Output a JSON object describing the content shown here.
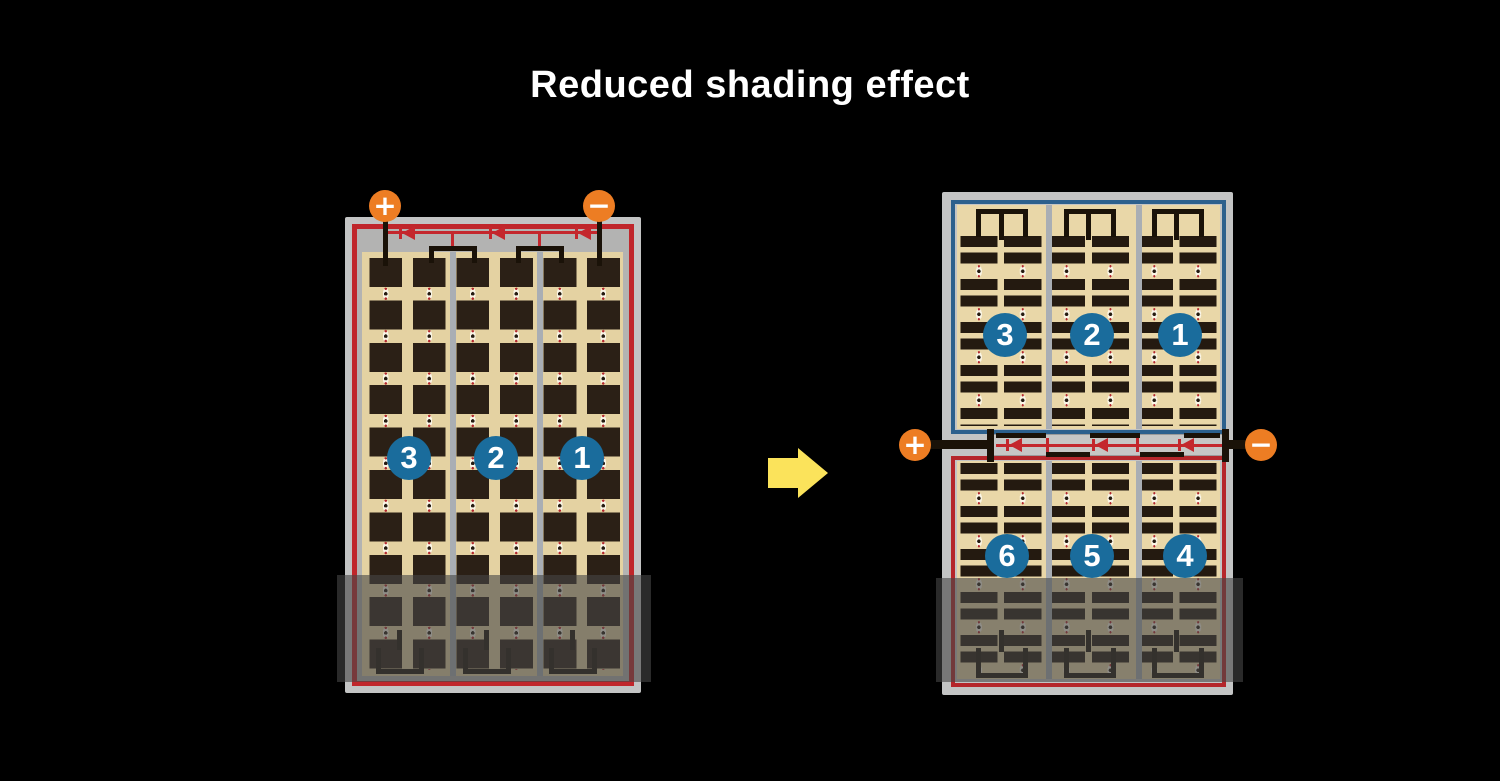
{
  "title": "Reduced shading effect",
  "left_module": {
    "description": "conventional full-cell module, series strings",
    "terminals": {
      "plus": "+",
      "minus": "−"
    },
    "cell_strings": [
      "3",
      "2",
      "1"
    ]
  },
  "right_module": {
    "description": "split half-cell module with central junction",
    "terminals": {
      "plus": "+",
      "minus": "−"
    },
    "top_half_strings": [
      "3",
      "2",
      "1"
    ],
    "bottom_half_strings": [
      "6",
      "5",
      "4"
    ]
  },
  "colors": {
    "background": "#000000",
    "title_text": "#ffffff",
    "terminal_orange": "#ed7d23",
    "string_badge_blue": "#1a6c9c",
    "series_red": "#c0262b",
    "half_border_blue": "#2c608d",
    "cell_dark": "#2b2016",
    "cell_tan": "#e4d2a2",
    "frame_gray": "#c3c4c4",
    "arrow_yellow": "#fbe35b",
    "shade_overlay": "rgba(70,70,70,0.6)"
  }
}
